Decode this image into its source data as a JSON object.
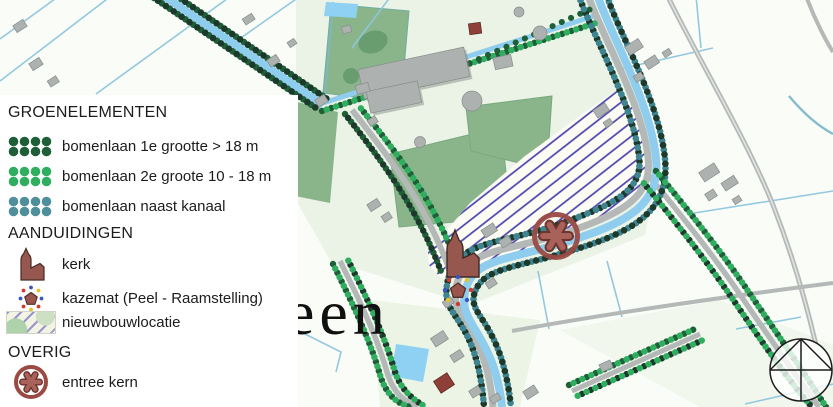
{
  "legend": {
    "sections": [
      {
        "title": "GROENELEMENTEN",
        "items": [
          {
            "label": "bomenlaan 1e grootte > 18 m",
            "icon": "tree-row-dark-green-icon"
          },
          {
            "label": "bomenlaan 2e groote 10 - 18 m",
            "icon": "tree-row-green-icon"
          },
          {
            "label": "bomenlaan naast kanaal",
            "icon": "tree-row-teal-icon"
          }
        ]
      },
      {
        "title": "AANDUIDINGEN",
        "items": [
          {
            "label": "kerk",
            "icon": "church-icon"
          },
          {
            "label": "kazemat (Peel - Raamstelling)",
            "icon": "kazemat-icon"
          },
          {
            "label": "nieuwbouwlocatie",
            "icon": "new-development-hatch-icon"
          }
        ]
      },
      {
        "title": "OVERIG",
        "items": [
          {
            "label": "entree kern",
            "icon": "village-entrance-icon"
          }
        ]
      }
    ]
  },
  "map": {
    "place_label_fragment": "een",
    "symbols": [
      "kerk",
      "kazemat",
      "entree kern",
      "nieuwbouwlocatie",
      "compass-north"
    ]
  },
  "colors": {
    "tree-dark": "#1e5f38",
    "tree-black": "#1c3a2b",
    "tree-green": "#2fae60",
    "tree-teal": "#3f8591",
    "canal-blue": "#8fcdee",
    "road-gray": "#b4b8b6",
    "field-line": "#8ec6de",
    "green-area": "#8ab58b",
    "green-dark": "#699c6e",
    "hatch-line": "#4a43ad",
    "marker-red": "#9a4a42",
    "marker-red-dark": "#6e332c",
    "marker-red-light": "#a8625a",
    "building-gray": "#adb2b0",
    "building-shadow": "#7e8481",
    "kerk-brown": "#96584e",
    "red-square": "#8e4038",
    "text-dark": "#1c1c1c"
  }
}
